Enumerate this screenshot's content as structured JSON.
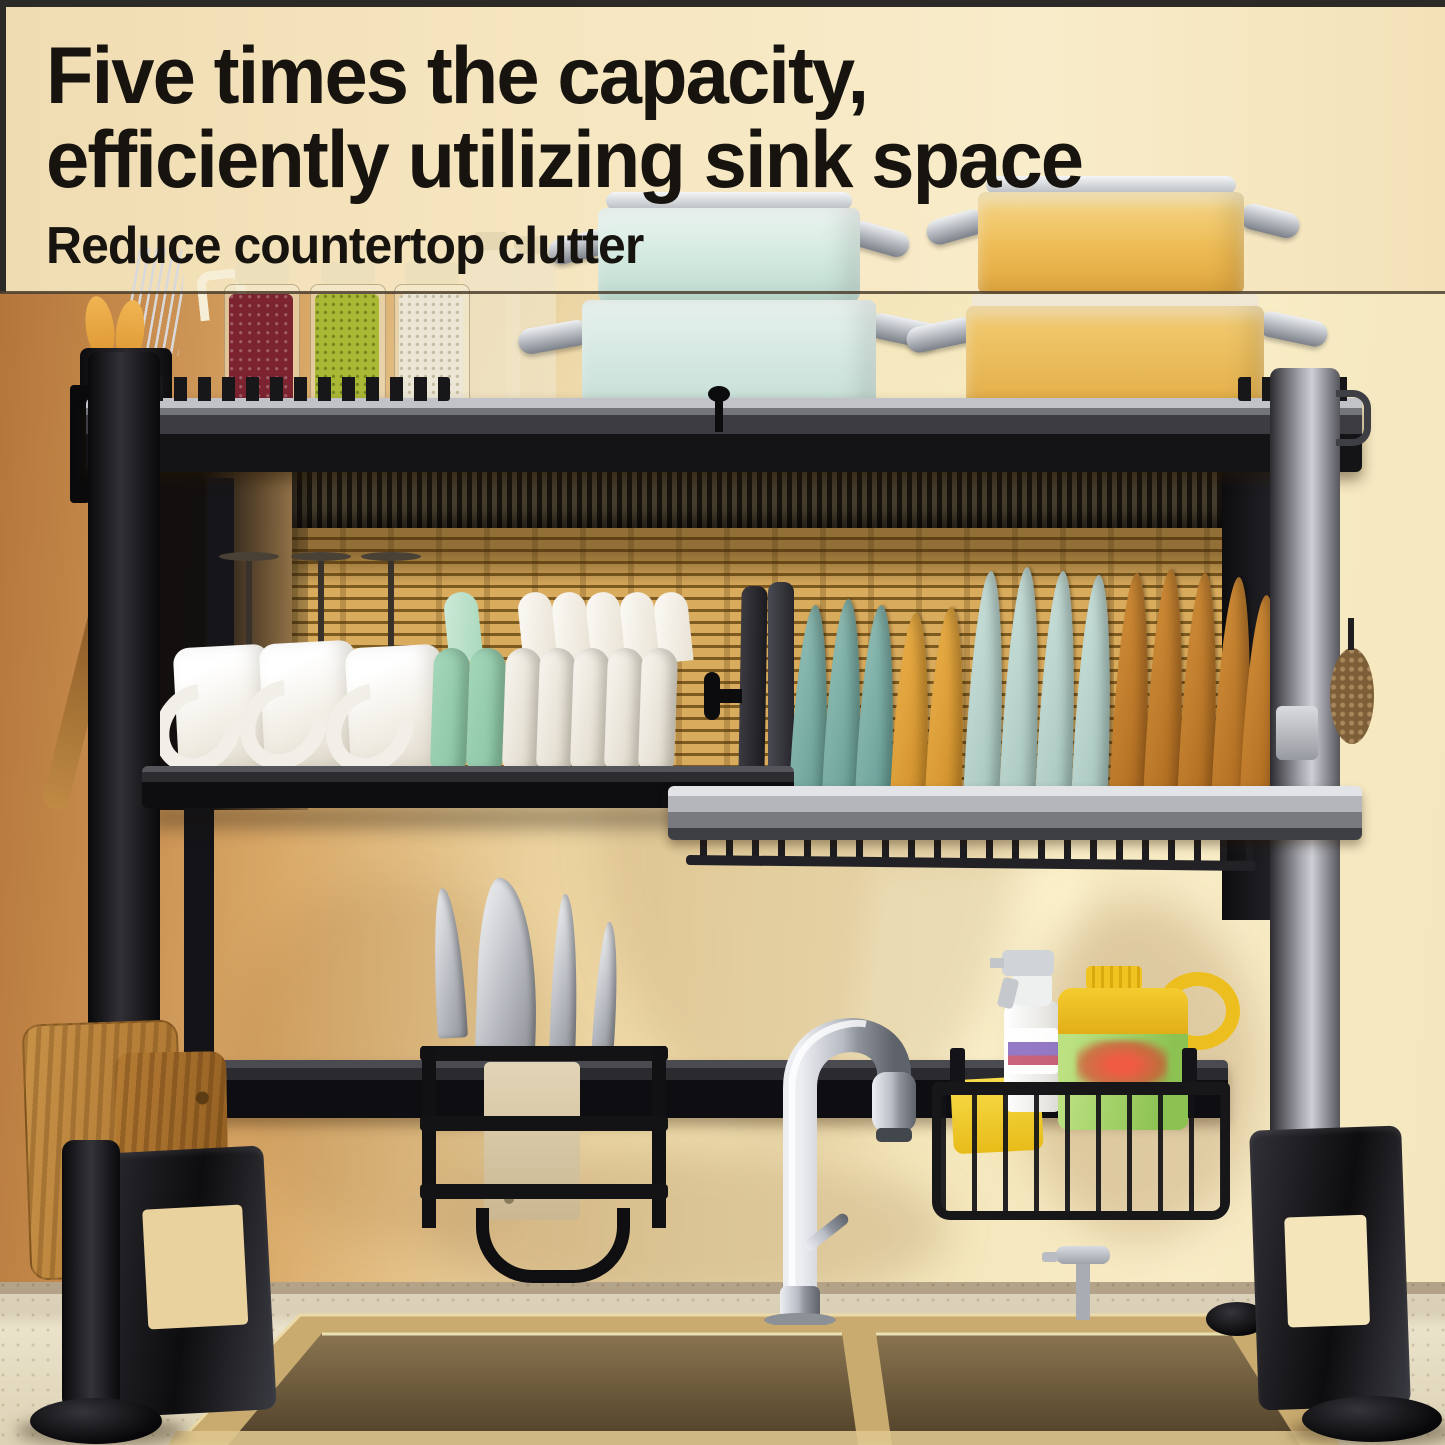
{
  "banner": {
    "headline_line1": "Five times the capacity,",
    "headline_line2": "efficiently utilizing sink space",
    "subheadline": "Reduce countertop clutter"
  },
  "palette": {
    "headline_text": "#17140f",
    "banner_background": "#f6e6c0",
    "wall_left": "#c4884a",
    "wall_right": "#f8ecc6",
    "backsplash_gold": "#d9ab5c",
    "rack_black": "#141417",
    "rack_silver": "#b4b6bc",
    "pot_mint": "#cfe7dd",
    "pot_yellow": "#edbb55",
    "plate_teal": "#93c0b7",
    "plate_yellow": "#ecb14a",
    "plate_mint": "#cce2dc",
    "plate_amber": "#d3903a",
    "ceramic_white": "#f3f0e8",
    "bowl_mint": "#a5d7ba",
    "sponge_yellow": "#f2cf2a",
    "soap_jug_green": "#9fcf63",
    "soap_jug_cap": "#eec01c",
    "cutting_board_wood": "#b67c34",
    "countertop": "#e7dfc8",
    "sink_rim": "#c9ab70",
    "sink_bowl": "#6e5b40",
    "steel_chrome": "#c9ccd2"
  },
  "objects": [
    "over-sink-dish-rack",
    "utensil-holder",
    "chopsticks",
    "spice-jars",
    "mint-pot-stack",
    "yellow-pot-stack",
    "wine-glasses",
    "white-mugs",
    "bowls",
    "pot-lid",
    "drying-plates",
    "knife-holder",
    "kitchen-faucet",
    "sponge-basket",
    "spray-bottle",
    "dish-soap-jug",
    "cutting-boards",
    "double-bowl-sink",
    "soap-dispenser"
  ]
}
